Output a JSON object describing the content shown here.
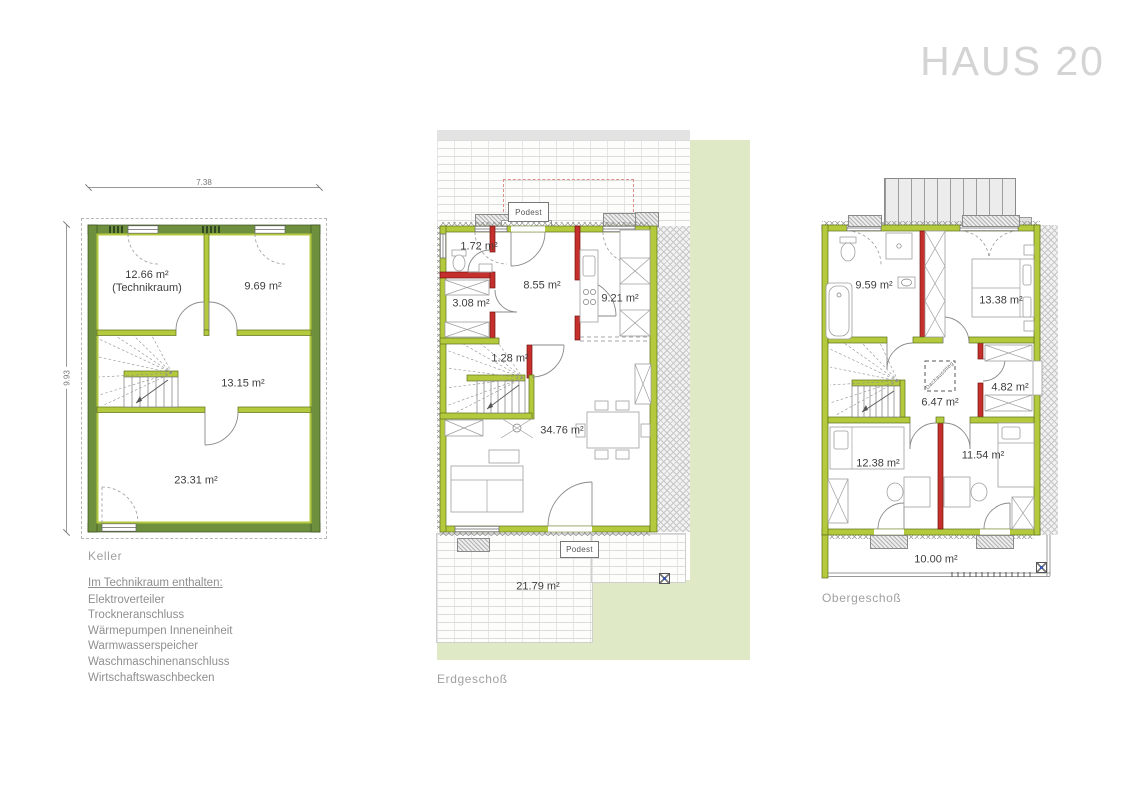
{
  "title": "HAUS 20",
  "colors": {
    "exterior_wall_green": "#b5c93c",
    "basement_wall_green": "#6d8f3e",
    "interior_wall_red": "#c5302c",
    "lawn_green": "#e0e9c6",
    "title_gray": "#d4d4d4"
  },
  "floors": {
    "keller": {
      "label": "Keller",
      "dim_width": "7.38",
      "dim_height": "9.93",
      "room_technik_area": "12.66 m²",
      "room_technik_name": "(Technikraum)",
      "room_2": "9.69 m²",
      "room_3": "13.15 m²",
      "room_4": "23.31 m²",
      "notes_heading": "Im Technikraum enthalten:",
      "notes": [
        "Elektroverteiler",
        "Trockneranschluss",
        "Wärmepumpen Inneneinheit",
        "Warmwasserspeicher",
        "Waschmaschinenanschluss",
        "Wirtschaftswaschbecken"
      ]
    },
    "eg": {
      "label": "Erdgeschoß",
      "podest_top": "Podest",
      "podest_bottom": "Podest",
      "room_wc": "1.72 m²",
      "room_abstell": "3.08 m²",
      "room_flur": "8.55 m²",
      "room_kueche": "9.21 m²",
      "room_garderobe": "1.28 m²",
      "room_wohnen": "34.76 m²",
      "room_terrasse": "21.79 m²"
    },
    "og": {
      "label": "Obergeschoß",
      "attic_access": "Dachausstieg",
      "room_bad": "9.59 m²",
      "room_schlafen": "13.38 m²",
      "room_flur": "6.47 m²",
      "room_abstell": "4.82 m²",
      "room_kind1": "12.38 m²",
      "room_kind2": "11.54 m²",
      "room_balkon": "10.00 m²"
    }
  }
}
